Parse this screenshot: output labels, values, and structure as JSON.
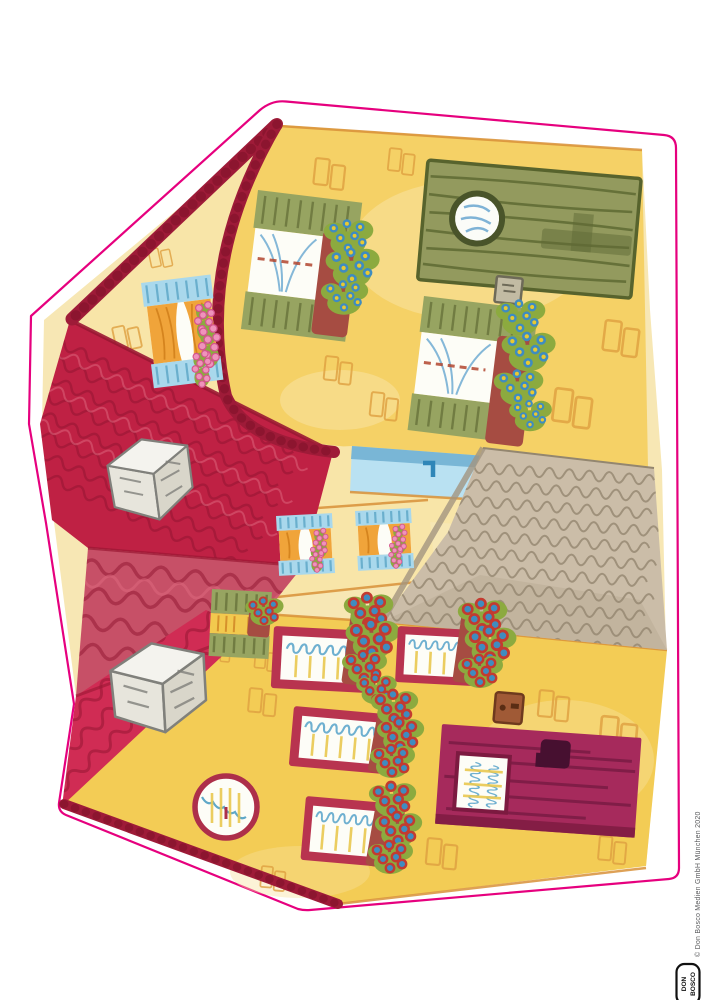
{
  "page": {
    "copyright": "© Don Bosco Medien GmbH München 2020",
    "logo": {
      "line1": "DON",
      "line2": "BOSCO"
    }
  },
  "colors": {
    "cutline": "#e6007e",
    "paper": "#ffffff",
    "wall_base": "#f7e7b4",
    "wall_yellow": "#f5d166",
    "wall_cream": "#f8e5a8",
    "wall_deep": "#f3cc55",
    "brick": "#dfa040",
    "yellow_line": "#e9c84f",
    "roof_crimson": "#bf2144",
    "roof_light": "#c75067",
    "roof_bright": "#d02c54",
    "ridge": "#9e1b38",
    "shingle_line": "#8f1430",
    "cobble": "#cbbda8",
    "cobble_line": "#93866f",
    "green_door": "#939a5e",
    "green_door_dark": "#57632d",
    "shutter_green": "#97a461",
    "shutter_green_dark": "#6a763d",
    "shutter_blue": "#a9d8ec",
    "shutter_blue_dark": "#5fa8c8",
    "curtain_orange": "#f0a43a",
    "curtain_orange_dark": "#d07f1a",
    "curtain_white": "#fdfdf7",
    "curtain_blue": "#85b8d8",
    "frame_red": "#b8344f",
    "door_magenta": "#a62a5c",
    "door_magenta_dark": "#731a40",
    "flower_pink": "#ef93bb",
    "flower_blue": "#3f8cc0",
    "flower_yellow": "#e9c931",
    "foliage": "#8caa3f",
    "berry_ring": "#c33b30",
    "box_brown": "#a64c42",
    "bell_brown": "#a05a36",
    "chimney_line": "#80807b",
    "sky_blue": "#b9e1f2",
    "sky_blue_dark": "#79b6d6",
    "text_gray": "#58595b"
  }
}
